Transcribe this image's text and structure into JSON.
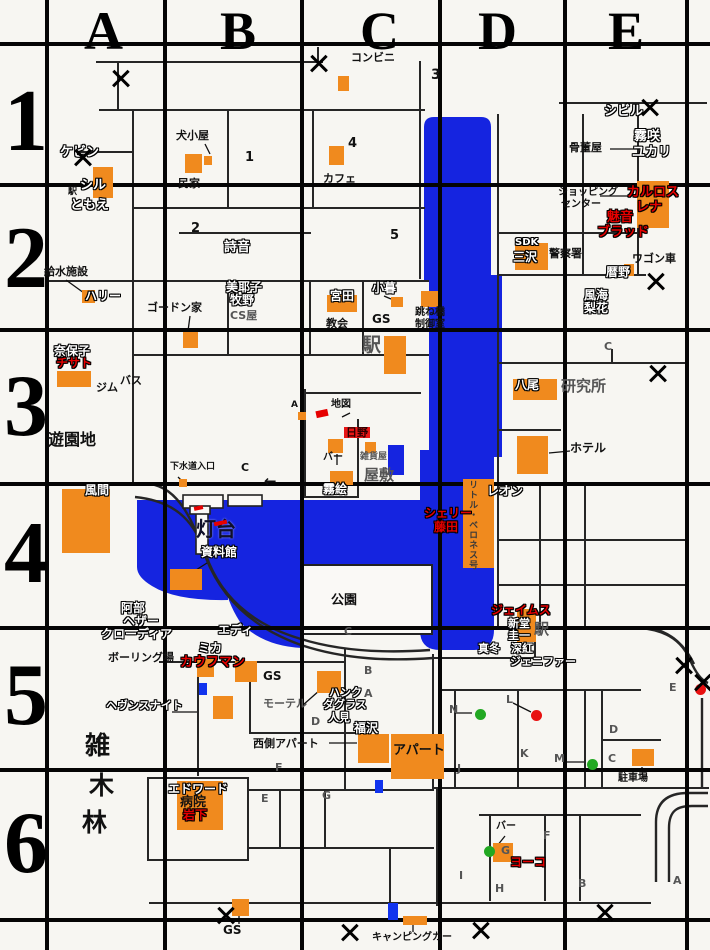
{
  "map_title": "town map with character locations",
  "colors": {
    "bg": "#f7f6f2",
    "water": "#1524e0",
    "building": "#f08a1e",
    "street": "#262626",
    "grid": "#050505",
    "red": "#e60000",
    "badge": "#e81616",
    "green_dot": "#22a822",
    "red_dot": "#e81010",
    "bluemark": "#1133ee"
  },
  "grid": {
    "columns": [
      {
        "label": "A",
        "x": 84
      },
      {
        "label": "B",
        "x": 220
      },
      {
        "label": "C",
        "x": 360
      },
      {
        "label": "D",
        "x": 478
      },
      {
        "label": "E",
        "x": 608
      }
    ],
    "rows": [
      {
        "label": "1",
        "y": 78
      },
      {
        "label": "2",
        "y": 215
      },
      {
        "label": "3",
        "y": 363
      },
      {
        "label": "4",
        "y": 510
      },
      {
        "label": "5",
        "y": 652
      },
      {
        "label": "6",
        "y": 800
      }
    ]
  },
  "labels": [
    {
      "t": "コンビニ",
      "x": 351,
      "y": 52,
      "s": "k",
      "fs": 11
    },
    {
      "t": "3",
      "x": 431,
      "y": 68,
      "s": "k",
      "fs": 14
    },
    {
      "t": "シビル",
      "x": 604,
      "y": 105,
      "s": "w",
      "fs": 13
    },
    {
      "t": "犬小屋",
      "x": 176,
      "y": 130,
      "s": "k",
      "fs": 11
    },
    {
      "t": "1",
      "x": 245,
      "y": 151,
      "s": "k",
      "fs": 13
    },
    {
      "t": "4",
      "x": 348,
      "y": 137,
      "s": "k",
      "fs": 13
    },
    {
      "t": "民家",
      "x": 178,
      "y": 178,
      "s": "k",
      "fs": 11
    },
    {
      "t": "カフェ",
      "x": 323,
      "y": 173,
      "s": "k",
      "fs": 11
    },
    {
      "t": "ケビン",
      "x": 60,
      "y": 146,
      "s": "w",
      "fs": 13
    },
    {
      "t": "駅",
      "x": 68,
      "y": 188,
      "s": "k",
      "fs": 9
    },
    {
      "t": "シル",
      "x": 80,
      "y": 179,
      "s": "w",
      "fs": 13
    },
    {
      "t": "ともえ",
      "x": 70,
      "y": 199,
      "s": "w",
      "fs": 13
    },
    {
      "t": "骨董屋",
      "x": 569,
      "y": 142,
      "s": "k",
      "fs": 11
    },
    {
      "t": "霧咲",
      "x": 634,
      "y": 130,
      "s": "w",
      "fs": 13
    },
    {
      "t": "ユカリ",
      "x": 632,
      "y": 146,
      "s": "w",
      "fs": 13
    },
    {
      "t": "ショッピング",
      "x": 558,
      "y": 188,
      "s": "k",
      "fs": 10
    },
    {
      "t": "センター",
      "x": 561,
      "y": 200,
      "s": "k",
      "fs": 10
    },
    {
      "t": "カルロス",
      "x": 627,
      "y": 186,
      "s": "r",
      "fs": 13
    },
    {
      "t": "レナ",
      "x": 636,
      "y": 201,
      "s": "r",
      "fs": 13
    },
    {
      "t": "魅音",
      "x": 607,
      "y": 211,
      "s": "r",
      "fs": 13
    },
    {
      "t": "ブラッド",
      "x": 597,
      "y": 226,
      "s": "r",
      "fs": 13
    },
    {
      "t": "2",
      "x": 191,
      "y": 222,
      "s": "k",
      "fs": 13
    },
    {
      "t": "詩音",
      "x": 224,
      "y": 241,
      "s": "w",
      "fs": 13
    },
    {
      "t": "5",
      "x": 390,
      "y": 229,
      "s": "k",
      "fs": 13
    },
    {
      "t": "SDK",
      "x": 515,
      "y": 238,
      "s": "w",
      "fs": 10
    },
    {
      "t": "三沢",
      "x": 513,
      "y": 251,
      "s": "w",
      "fs": 12
    },
    {
      "t": "警察署",
      "x": 549,
      "y": 248,
      "s": "k",
      "fs": 11
    },
    {
      "t": "ワゴン車",
      "x": 632,
      "y": 253,
      "s": "k",
      "fs": 11
    },
    {
      "t": "暦野",
      "x": 606,
      "y": 266,
      "s": "w",
      "fs": 12
    },
    {
      "t": "給水施設",
      "x": 44,
      "y": 266,
      "s": "k",
      "fs": 11
    },
    {
      "t": "ハリー",
      "x": 85,
      "y": 290,
      "s": "w",
      "fs": 12
    },
    {
      "t": "美耶子",
      "x": 226,
      "y": 281,
      "s": "w",
      "fs": 12
    },
    {
      "t": "牧野",
      "x": 230,
      "y": 294,
      "s": "w",
      "fs": 12
    },
    {
      "t": "CS屋",
      "x": 230,
      "y": 310,
      "s": "g",
      "fs": 11
    },
    {
      "t": "ゴードン家",
      "x": 147,
      "y": 302,
      "s": "k",
      "fs": 11
    },
    {
      "t": "宮田",
      "x": 330,
      "y": 290,
      "s": "w",
      "fs": 12
    },
    {
      "t": "小暮",
      "x": 372,
      "y": 282,
      "s": "w",
      "fs": 12
    },
    {
      "t": "教会",
      "x": 326,
      "y": 318,
      "s": "k",
      "fs": 11
    },
    {
      "t": "GS",
      "x": 372,
      "y": 313,
      "s": "k",
      "fs": 12
    },
    {
      "t": "駅",
      "x": 362,
      "y": 336,
      "s": "g",
      "fs": 19
    },
    {
      "t": "跳ね橋",
      "x": 415,
      "y": 308,
      "s": "k",
      "fs": 10
    },
    {
      "t": "制御室",
      "x": 415,
      "y": 320,
      "s": "k",
      "fs": 10
    },
    {
      "t": "風海",
      "x": 584,
      "y": 289,
      "s": "w",
      "fs": 12
    },
    {
      "t": "梨花",
      "x": 584,
      "y": 302,
      "s": "w",
      "fs": 12
    },
    {
      "t": "C",
      "x": 604,
      "y": 341,
      "s": "g",
      "fs": 11
    },
    {
      "t": "奈保子",
      "x": 54,
      "y": 345,
      "s": "w",
      "fs": 12
    },
    {
      "t": "チサト",
      "x": 56,
      "y": 357,
      "s": "r",
      "fs": 12
    },
    {
      "t": "ジム",
      "x": 96,
      "y": 382,
      "s": "k",
      "fs": 11
    },
    {
      "t": "バス",
      "x": 120,
      "y": 375,
      "s": "k",
      "fs": 11
    },
    {
      "t": "八尾",
      "x": 515,
      "y": 379,
      "s": "w",
      "fs": 12
    },
    {
      "t": "研究所",
      "x": 561,
      "y": 379,
      "s": "g",
      "fs": 15
    },
    {
      "t": "ホテル",
      "x": 570,
      "y": 442,
      "s": "k",
      "fs": 12
    },
    {
      "t": "遊園地",
      "x": 48,
      "y": 432,
      "s": "k",
      "fs": 16
    },
    {
      "t": "風間",
      "x": 85,
      "y": 484,
      "s": "w",
      "fs": 12
    },
    {
      "t": "下水道入口",
      "x": 170,
      "y": 463,
      "s": "k",
      "fs": 9
    },
    {
      "t": "C",
      "x": 241,
      "y": 462,
      "s": "k",
      "fs": 11
    },
    {
      "t": "地図",
      "x": 331,
      "y": 400,
      "s": "k",
      "fs": 10
    },
    {
      "t": "A",
      "x": 291,
      "y": 401,
      "s": "k",
      "fs": 9
    },
    {
      "t": "日野",
      "x": 344,
      "y": 427,
      "s": "rb",
      "fs": 11
    },
    {
      "t": "バー",
      "x": 323,
      "y": 453,
      "s": "k",
      "fs": 10
    },
    {
      "t": "雑貨屋",
      "x": 360,
      "y": 453,
      "s": "g",
      "fs": 9
    },
    {
      "t": "屋敷",
      "x": 364,
      "y": 468,
      "s": "g",
      "fs": 15
    },
    {
      "t": "霧絵",
      "x": 323,
      "y": 483,
      "s": "w",
      "fs": 12
    },
    {
      "t": "灯台",
      "x": 196,
      "y": 519,
      "s": "b",
      "fs": 20
    },
    {
      "t": "資料館",
      "x": 201,
      "y": 546,
      "s": "w",
      "fs": 12
    },
    {
      "t": "←",
      "x": 264,
      "y": 474,
      "s": "k",
      "fs": 15
    },
    {
      "t": "シェリー",
      "x": 424,
      "y": 507,
      "s": "r",
      "fs": 12
    },
    {
      "t": "藤田",
      "x": 434,
      "y": 521,
      "s": "r",
      "fs": 12
    },
    {
      "t": "レオン",
      "x": 487,
      "y": 485,
      "s": "w",
      "fs": 12
    },
    {
      "t": "リトル・ベロネス号",
      "x": 467,
      "y": 480,
      "s": "v",
      "fs": 9
    },
    {
      "t": "公園",
      "x": 331,
      "y": 594,
      "s": "k",
      "fs": 13
    },
    {
      "t": "C",
      "x": 344,
      "y": 626,
      "s": "g",
      "fs": 11
    },
    {
      "t": "阿部",
      "x": 121,
      "y": 602,
      "s": "w",
      "fs": 12
    },
    {
      "t": "ヘザー",
      "x": 123,
      "y": 615,
      "s": "w",
      "fs": 12
    },
    {
      "t": "クローディア",
      "x": 101,
      "y": 628,
      "s": "w",
      "fs": 12
    },
    {
      "t": "エディ",
      "x": 218,
      "y": 624,
      "s": "w",
      "fs": 12
    },
    {
      "t": "ミカ",
      "x": 198,
      "y": 642,
      "s": "w",
      "fs": 12
    },
    {
      "t": "カウフマン",
      "x": 180,
      "y": 656,
      "s": "r",
      "fs": 13
    },
    {
      "t": "ボーリング場",
      "x": 108,
      "y": 652,
      "s": "k",
      "fs": 11
    },
    {
      "t": "GS",
      "x": 263,
      "y": 670,
      "s": "k",
      "fs": 12
    },
    {
      "t": "モーテル",
      "x": 263,
      "y": 698,
      "s": "g",
      "fs": 11
    },
    {
      "t": "ヘヴンスナイト",
      "x": 106,
      "y": 700,
      "s": "w",
      "fs": 11
    },
    {
      "t": "ハンク",
      "x": 329,
      "y": 687,
      "s": "w",
      "fs": 11
    },
    {
      "t": "ダグラス",
      "x": 323,
      "y": 699,
      "s": "w",
      "fs": 11
    },
    {
      "t": "人見",
      "x": 328,
      "y": 712,
      "s": "w",
      "fs": 11
    },
    {
      "t": "西側アパート",
      "x": 253,
      "y": 738,
      "s": "k",
      "fs": 11
    },
    {
      "t": "福沢",
      "x": 354,
      "y": 722,
      "s": "w",
      "fs": 12
    },
    {
      "t": "アパート",
      "x": 393,
      "y": 744,
      "s": "kb",
      "fs": 13
    },
    {
      "t": "ジェイムス",
      "x": 491,
      "y": 604,
      "s": "r",
      "fs": 12
    },
    {
      "t": "新堂",
      "x": 508,
      "y": 618,
      "s": "w",
      "fs": 11
    },
    {
      "t": "圭一",
      "x": 508,
      "y": 630,
      "s": "w",
      "fs": 11
    },
    {
      "t": "真冬",
      "x": 478,
      "y": 643,
      "s": "w",
      "fs": 11
    },
    {
      "t": "深紅",
      "x": 511,
      "y": 643,
      "s": "w",
      "fs": 11
    },
    {
      "t": "ジェニファー",
      "x": 510,
      "y": 656,
      "s": "w",
      "fs": 11
    },
    {
      "t": "駅",
      "x": 534,
      "y": 622,
      "s": "g",
      "fs": 15
    },
    {
      "t": "雑",
      "x": 85,
      "y": 733,
      "s": "k",
      "fs": 25
    },
    {
      "t": "木",
      "x": 89,
      "y": 773,
      "s": "k",
      "fs": 25
    },
    {
      "t": "林",
      "x": 82,
      "y": 810,
      "s": "k",
      "fs": 25
    },
    {
      "t": "エドワード",
      "x": 168,
      "y": 783,
      "s": "w",
      "fs": 12
    },
    {
      "t": "病院",
      "x": 180,
      "y": 796,
      "s": "kb",
      "fs": 13
    },
    {
      "t": "岩下",
      "x": 183,
      "y": 809,
      "s": "r",
      "fs": 12
    },
    {
      "t": "駐車場",
      "x": 618,
      "y": 774,
      "s": "k",
      "fs": 10
    },
    {
      "t": "バー",
      "x": 496,
      "y": 822,
      "s": "k",
      "fs": 10
    },
    {
      "t": "ヨーコ",
      "x": 510,
      "y": 856,
      "s": "r",
      "fs": 12
    },
    {
      "t": "キャンピングカー",
      "x": 372,
      "y": 933,
      "s": "k",
      "fs": 10
    },
    {
      "t": "GS",
      "x": 223,
      "y": 924,
      "s": "k",
      "fs": 12
    },
    {
      "t": "N",
      "x": 449,
      "y": 704,
      "s": "g",
      "fs": 11
    },
    {
      "t": "J",
      "x": 457,
      "y": 763,
      "s": "g",
      "fs": 11
    },
    {
      "t": "K",
      "x": 520,
      "y": 748,
      "s": "g",
      "fs": 11
    },
    {
      "t": "L",
      "x": 506,
      "y": 694,
      "s": "g",
      "fs": 11
    },
    {
      "t": "M",
      "x": 554,
      "y": 753,
      "s": "g",
      "fs": 11
    },
    {
      "t": "C",
      "x": 608,
      "y": 753,
      "s": "g",
      "fs": 11
    },
    {
      "t": "D",
      "x": 609,
      "y": 724,
      "s": "g",
      "fs": 11
    },
    {
      "t": "A",
      "x": 673,
      "y": 875,
      "s": "g",
      "fs": 11
    },
    {
      "t": "B",
      "x": 578,
      "y": 878,
      "s": "g",
      "fs": 11
    },
    {
      "t": "H",
      "x": 495,
      "y": 883,
      "s": "g",
      "fs": 11
    },
    {
      "t": "I",
      "x": 459,
      "y": 870,
      "s": "g",
      "fs": 11
    },
    {
      "t": "F",
      "x": 543,
      "y": 830,
      "s": "g",
      "fs": 11
    },
    {
      "t": "G",
      "x": 501,
      "y": 845,
      "s": "g",
      "fs": 11
    },
    {
      "t": "E",
      "x": 669,
      "y": 682,
      "s": "g",
      "fs": 11
    },
    {
      "t": "D",
      "x": 311,
      "y": 716,
      "s": "g",
      "fs": 11
    },
    {
      "t": "F",
      "x": 275,
      "y": 762,
      "s": "g",
      "fs": 11
    },
    {
      "t": "E",
      "x": 261,
      "y": 793,
      "s": "g",
      "fs": 11
    },
    {
      "t": "G",
      "x": 322,
      "y": 790,
      "s": "g",
      "fs": 11
    },
    {
      "t": "B",
      "x": 364,
      "y": 665,
      "s": "g",
      "fs": 11
    },
    {
      "t": "A",
      "x": 364,
      "y": 688,
      "s": "g",
      "fs": 11
    }
  ],
  "buildings": [
    [
      93,
      167,
      20,
      31
    ],
    [
      185,
      154,
      17,
      19
    ],
    [
      204,
      156,
      8,
      9
    ],
    [
      329,
      146,
      15,
      19
    ],
    [
      338,
      76,
      11,
      15
    ],
    [
      82,
      290,
      13,
      13
    ],
    [
      183,
      332,
      15,
      16
    ],
    [
      57,
      371,
      34,
      16
    ],
    [
      327,
      295,
      30,
      17
    ],
    [
      391,
      297,
      12,
      10
    ],
    [
      384,
      336,
      22,
      38
    ],
    [
      421,
      291,
      17,
      16
    ],
    [
      515,
      243,
      33,
      27
    ],
    [
      624,
      264,
      10,
      12
    ],
    [
      637,
      181,
      32,
      47
    ],
    [
      513,
      379,
      44,
      21
    ],
    [
      517,
      436,
      31,
      38
    ],
    [
      62,
      489,
      48,
      64
    ],
    [
      328,
      439,
      15,
      14
    ],
    [
      365,
      442,
      11,
      11
    ],
    [
      330,
      471,
      23,
      14
    ],
    [
      170,
      569,
      32,
      21
    ],
    [
      463,
      479,
      31,
      89
    ],
    [
      519,
      457,
      27,
      17
    ],
    [
      517,
      609,
      19,
      33
    ],
    [
      197,
      659,
      17,
      18
    ],
    [
      235,
      661,
      22,
      21
    ],
    [
      213,
      696,
      20,
      23
    ],
    [
      317,
      671,
      24,
      22
    ],
    [
      358,
      734,
      31,
      29
    ],
    [
      391,
      734,
      53,
      45
    ],
    [
      177,
      781,
      46,
      49
    ],
    [
      232,
      899,
      17,
      17
    ],
    [
      403,
      916,
      24,
      9
    ],
    [
      632,
      749,
      22,
      17
    ],
    [
      493,
      843,
      20,
      19
    ],
    [
      179,
      479,
      8,
      8
    ],
    [
      298,
      412,
      8,
      8
    ]
  ],
  "x_marks": [
    [
      121,
      78
    ],
    [
      83,
      157
    ],
    [
      319,
      63
    ],
    [
      650,
      107
    ],
    [
      656,
      281
    ],
    [
      658,
      373
    ],
    [
      684,
      665
    ],
    [
      703,
      682
    ],
    [
      226,
      915
    ],
    [
      350,
      932
    ],
    [
      481,
      930
    ],
    [
      605,
      912
    ]
  ],
  "dots": [
    {
      "x": 480,
      "y": 714,
      "c": "green"
    },
    {
      "x": 592,
      "y": 764,
      "c": "green"
    },
    {
      "x": 489,
      "y": 851,
      "c": "green"
    },
    {
      "x": 536,
      "y": 715,
      "c": "red"
    },
    {
      "x": 700,
      "y": 689,
      "c": "red"
    }
  ],
  "blue_markers": [
    [
      375,
      780,
      8,
      13
    ],
    [
      388,
      903,
      10,
      17
    ],
    [
      199,
      683,
      8,
      12
    ]
  ],
  "red_marks": [
    [
      316,
      410,
      12,
      7
    ],
    [
      194,
      506,
      9,
      4
    ],
    [
      214,
      521,
      13,
      4
    ]
  ]
}
